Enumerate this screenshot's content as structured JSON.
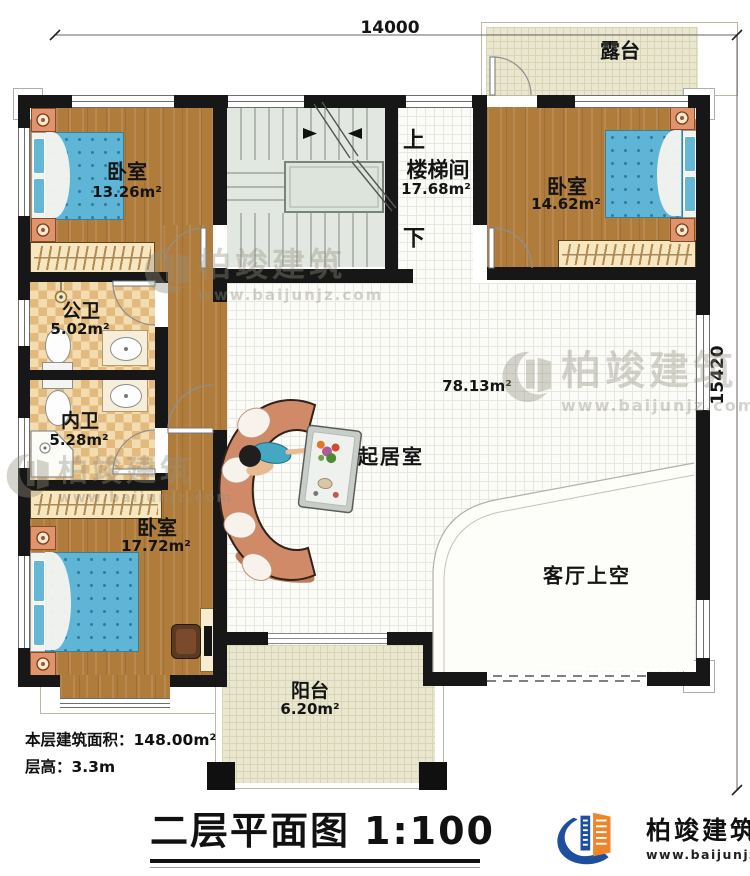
{
  "plan": {
    "dim_top": "14000",
    "dim_right": "15420",
    "rooms": {
      "terrace": {
        "name": "露台"
      },
      "bedroom_tl": {
        "name": "卧室",
        "area": "13.26m²"
      },
      "stairwell": {
        "name": "楼梯间",
        "area": "17.68m²",
        "up": "上",
        "down": "下"
      },
      "bedroom_tr": {
        "name": "卧室",
        "area": "14.62m²"
      },
      "public_bath": {
        "name": "公卫",
        "area": "5.02m²"
      },
      "inner_bath": {
        "name": "内卫",
        "area": "5.28m²"
      },
      "bedroom_b": {
        "name": "卧室",
        "area": "17.72m²"
      },
      "living": {
        "name": "起居室",
        "area": "78.13m²"
      },
      "void": {
        "name": "客厅上空"
      },
      "balcony": {
        "name": "阳台",
        "area": "6.20m²"
      }
    }
  },
  "notes": {
    "floor_area": "本层建筑面积：148.00m²",
    "floor_height": "层高：3.3m"
  },
  "title_block": {
    "title": "二层平面图",
    "scale": "1:100"
  },
  "brand": {
    "name": "柏竣建筑",
    "url": "www.baijunjz.com"
  },
  "watermark": {
    "name": "柏竣建筑",
    "url": "www.baijunjz.com"
  },
  "colors": {
    "wall": "#171717",
    "wood_floor": "#b07c3c",
    "bath_tile": "#e2ba7e",
    "terrace_tile": "#eae7d1",
    "stair": "#e2e7e1",
    "mattress_blue": "#5fb5d6",
    "sofa": "#d18a68",
    "brand_blue": "#1d4f9e",
    "brand_orange": "#f08428"
  }
}
